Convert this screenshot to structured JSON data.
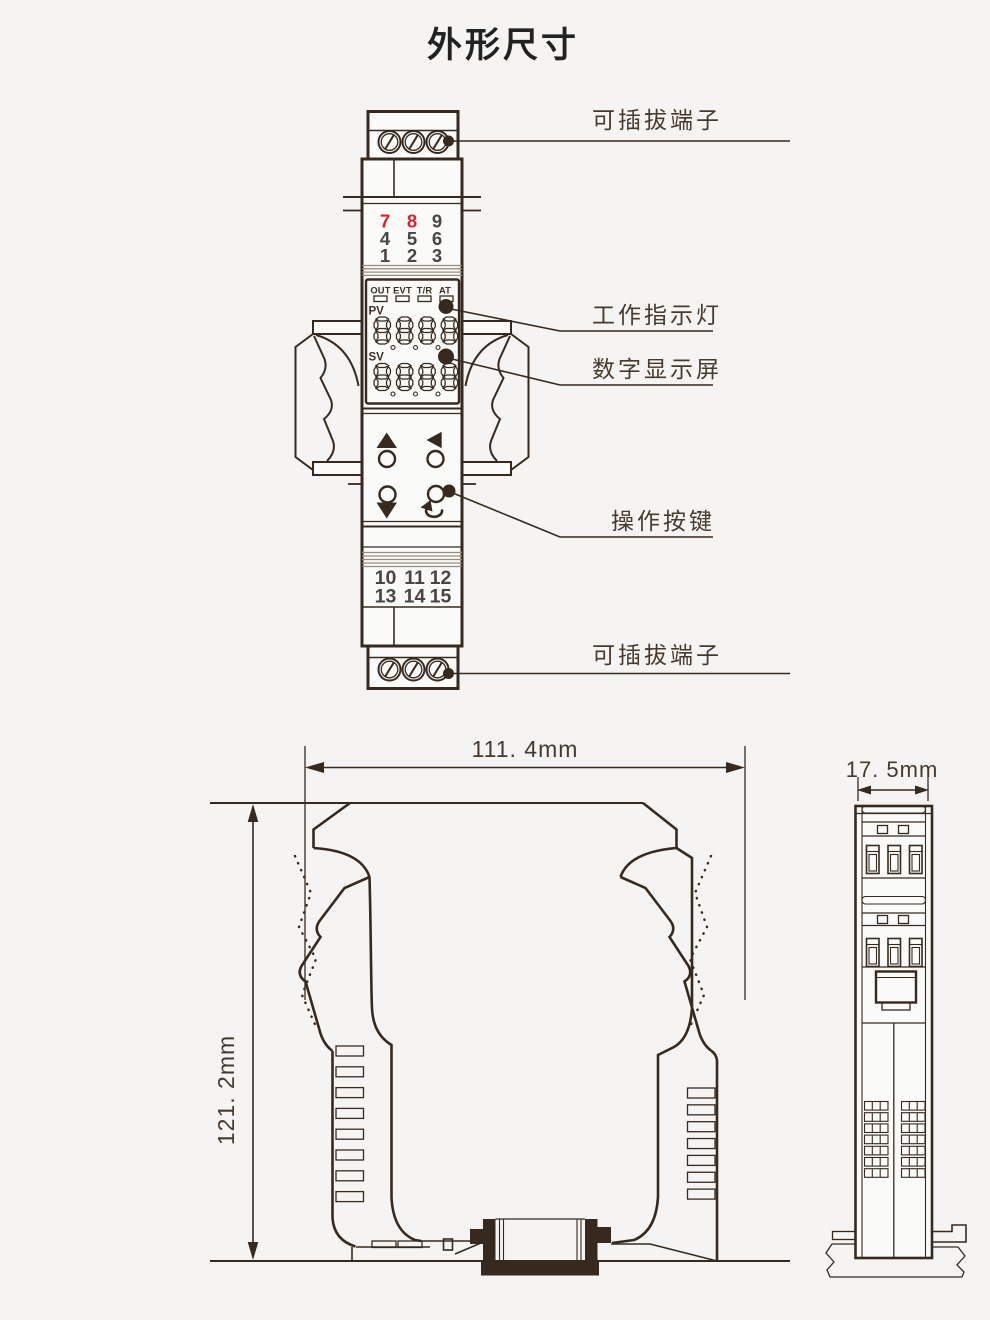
{
  "title": "外形尺寸",
  "front_view": {
    "label_top_terminal": "可插拔端子",
    "label_indicator_light": "工作指示灯",
    "label_digital_display": "数字显示屏",
    "label_operation_buttons": "操作按键",
    "label_bottom_terminal": "可插拔端子",
    "indicators": [
      "OUT",
      "EVT",
      "T/R",
      "AT"
    ],
    "pv_label": "PV",
    "sv_label": "SV",
    "pv_display": "8888",
    "sv_display": "8888",
    "terminals_top": [
      [
        "7",
        "8",
        "9"
      ],
      [
        "4",
        "5",
        "6"
      ],
      [
        "1",
        "2",
        "3"
      ]
    ],
    "terminals_bottom": [
      [
        "10",
        "11",
        "12"
      ],
      [
        "13",
        "14",
        "15"
      ]
    ]
  },
  "dimensions": {
    "width": "111. 4mm",
    "height": "121. 2mm",
    "depth": "17. 5mm"
  },
  "colors": {
    "ink": "#362a20",
    "red": "#d9232a",
    "digit_gray": "#4a4442",
    "background": "#f5f4f2"
  }
}
